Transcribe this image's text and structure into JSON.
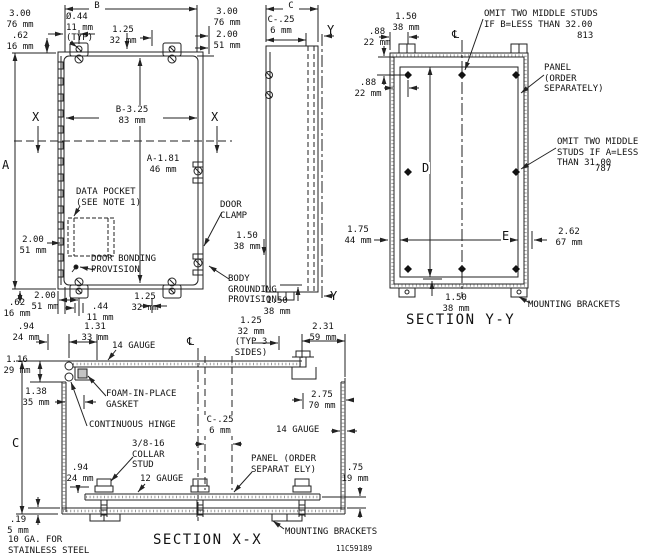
{
  "front": {
    "dim_b": "B",
    "tl_300": "3.00\n76 mm",
    "tl_62": ".62\n16 mm",
    "dia": "Ø.44\n11 mm\n(TYP)",
    "t_125": "1.25\n32 mm",
    "tr_300": "3.00\n76 mm",
    "tr_200": "2.00\n51 mm",
    "b_325": "B-3.25\n83 mm",
    "x_left": "X",
    "x_right": "X",
    "dim_a": "A",
    "a_181": "A-1.81\n46 mm",
    "data_pocket": "DATA POCKET\n(SEE NOTE 1)",
    "l_200": "2.00\n51 mm",
    "door_bonding": "DOOR BONDING\nPROVISION",
    "bb_62": ".62\n16 mm",
    "bb_200": "2.00\n51 mm",
    "bb_44": ".44\n11 mm",
    "bb_125": "1.25\n32 mm",
    "door_clamp": "DOOR\nCLAMP",
    "clamp_150": "1.50\n38 mm",
    "body_grounding": "BODY\nGROUNDING\nPROVISION"
  },
  "side": {
    "dim_c": "C",
    "c_25": "C-.25\n6 mm",
    "y_top": "Y",
    "y_bottom": "Y",
    "b_150": "1.50\n38 mm"
  },
  "yy": {
    "t_150": "1.50\n38 mm",
    "l_88a": ".88\n22 mm",
    "l_88b": ".88\n22 mm",
    "cl": "℄",
    "omit_b": "OMIT TWO MIDDLE STUDS\nIF B=LESS THAN 32.00",
    "omit_b_mm": "813",
    "panel": "PANEL\n(ORDER\nSEPARATELY)",
    "omit_a": "OMIT TWO MIDDLE\nSTUDS IF A=LESS\nTHAN 31.00",
    "omit_a_mm": "787",
    "dim_d": "D",
    "dim_e": "E",
    "l_175": "1.75\n44 mm",
    "r_262": "2.62\n67 mm",
    "b_150": "1.50\n38 mm",
    "brackets": "MOUNTING BRACKETS",
    "title": "SECTION Y-Y"
  },
  "xx": {
    "t_94": ".94\n24 mm",
    "t_131": "1.31\n33 mm",
    "gauge14_top": "14 GAUGE",
    "cl": "℄",
    "typ_125": "1.25\n32 mm\n(TYP 3\nSIDES)",
    "t_231": "2.31\n59 mm",
    "l_116": "1.16\n29 mm",
    "l_138": "1.38\n35 mm",
    "gasket": "FOAM-IN-PLACE\nGASKET",
    "hinge": "CONTINUOUS HINGE",
    "r_275": "2.75\n70 mm",
    "c_25": "C-.25\n6 mm",
    "gauge14_right": "14 GAUGE",
    "dim_c": "C",
    "collar": "3/8-16\nCOLLAR\nSTUD",
    "b_94": ".94\n24 mm",
    "gauge12": "12 GAUGE",
    "panel": "PANEL (ORDER\nSEPARAT ELY)",
    "r_75": ".75\n19 mm",
    "b_19": ".19\n5 mm",
    "stainless": "10 GA. FOR\nSTAINLESS STEEL",
    "brackets": "MOUNTING BRACKETS",
    "title": "SECTION X-X",
    "dwg_no": "11C59189"
  }
}
